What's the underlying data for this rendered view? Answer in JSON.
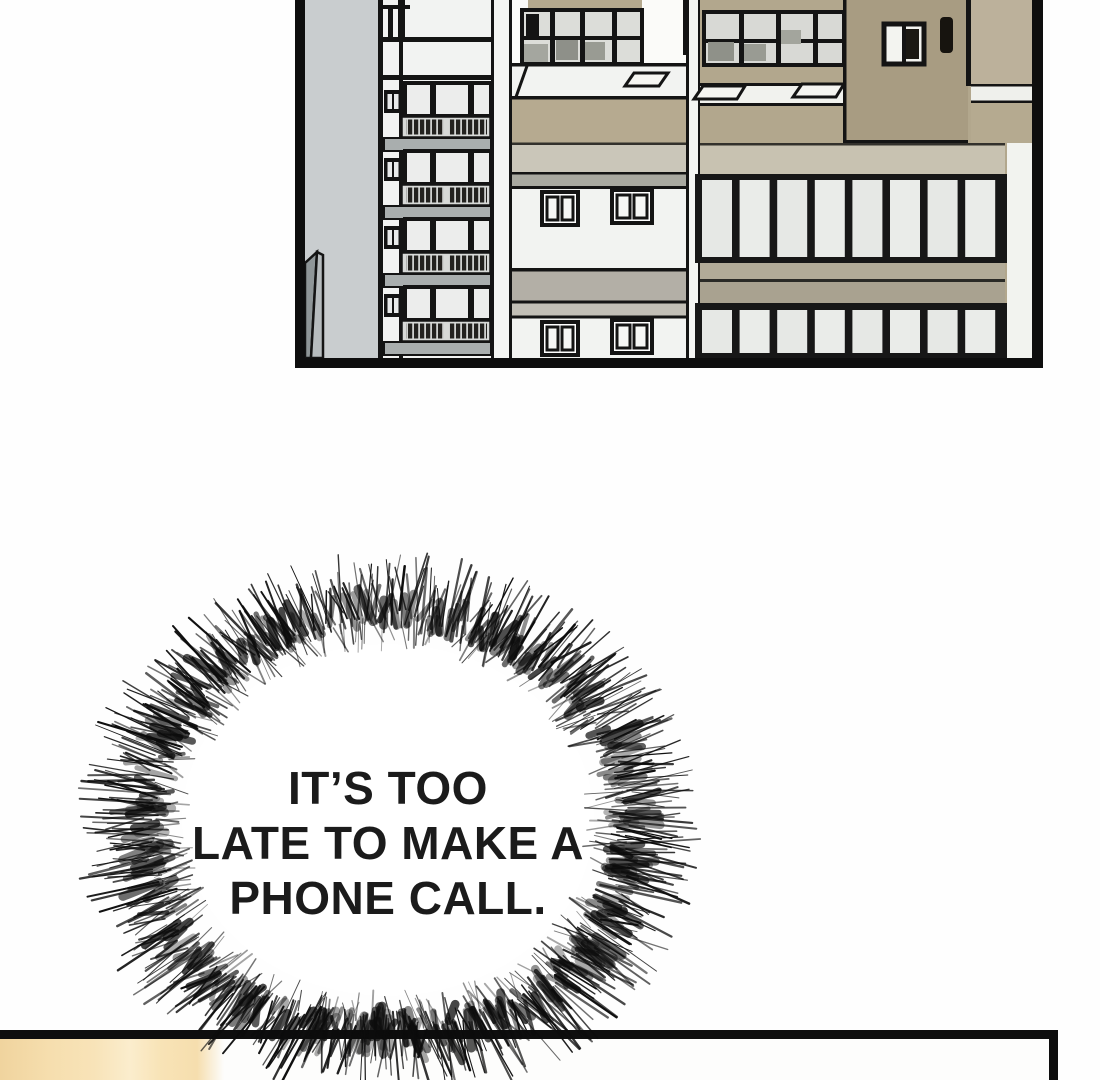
{
  "speech_bubble": {
    "line1": "IT’S TOO",
    "line2": "LATE TO MAKE A",
    "line3": "PHONE CALL."
  },
  "colors": {
    "page_background": "#fefefe",
    "panel_border": "#0e0e0e",
    "sky_grey": "#c9cdcf",
    "building_white": "#f0f1ef",
    "building_tan": "#b2a78d",
    "building_tan_dark": "#a89c82",
    "tan_band": "#b6aa90",
    "glass_pane": "#e9ebe8",
    "slab_grey": "#a9aeae",
    "cream_wall": "#f6deae",
    "bubble_ink": "#0c0c0c",
    "bubble_text": "#1b1b1b"
  }
}
